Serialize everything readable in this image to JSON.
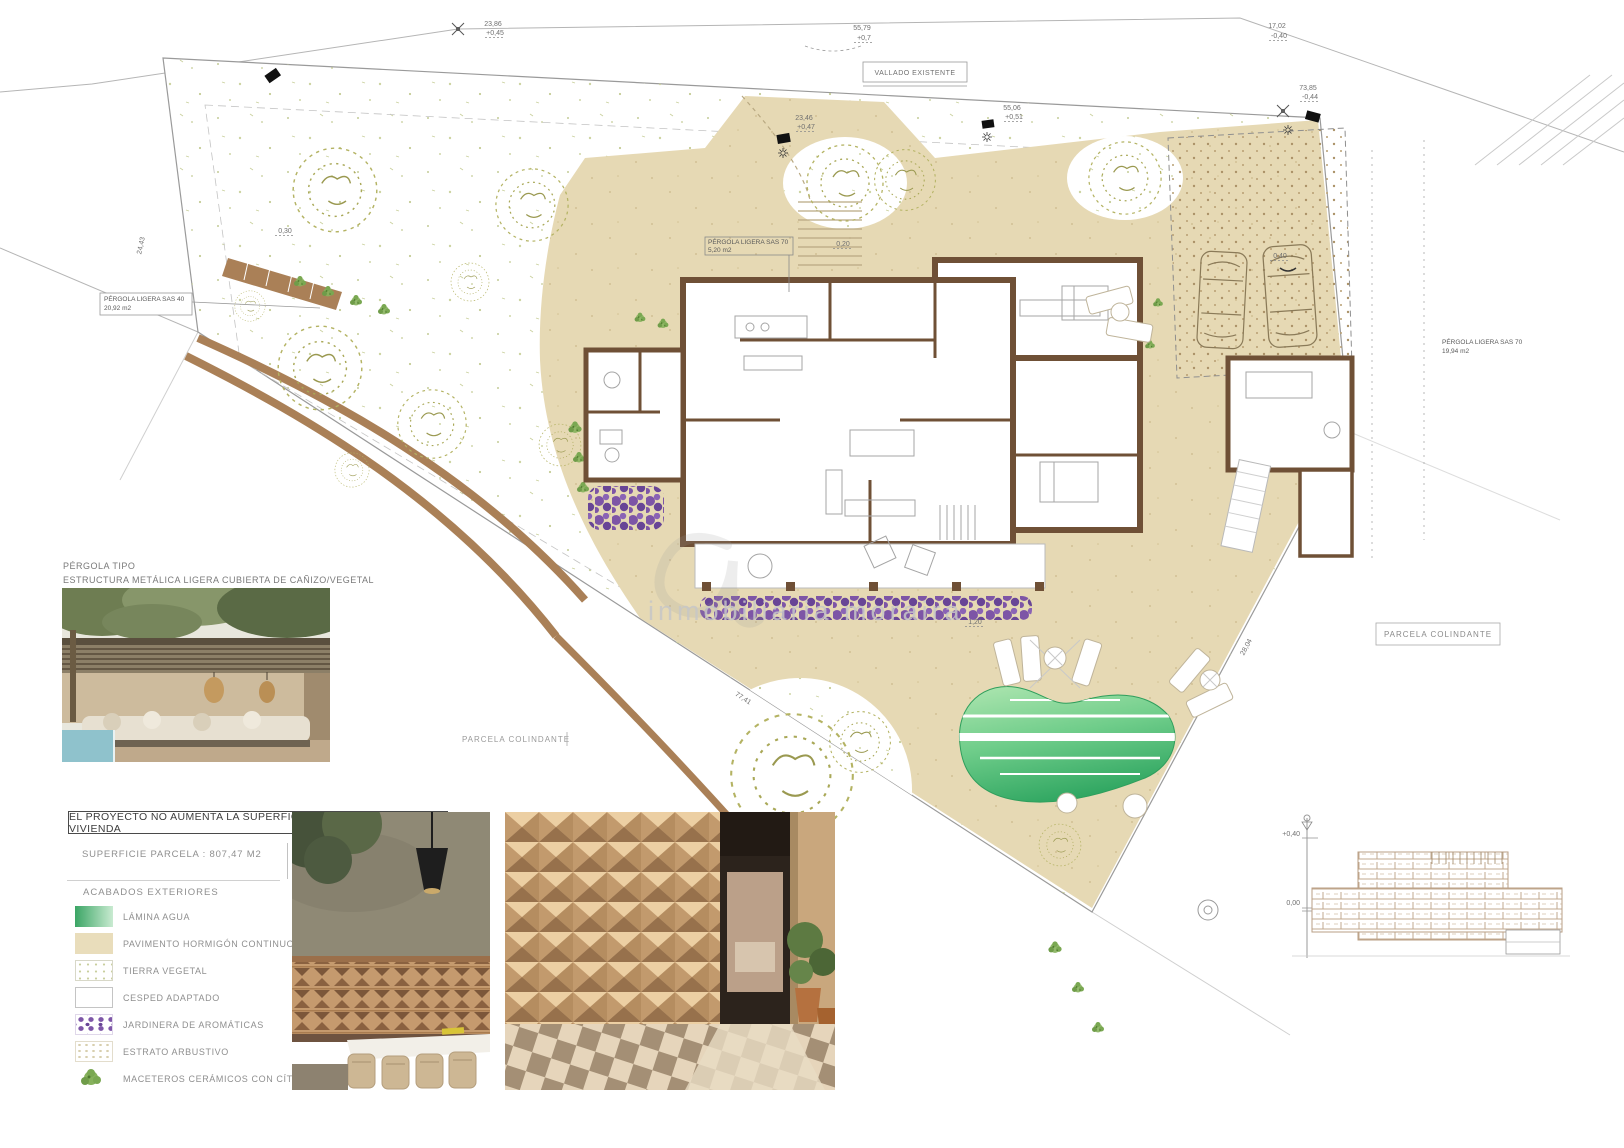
{
  "sheet": {
    "note": "EL PROYECTO NO AUMENTA LA SUPERFICIE CONSTRUIDA DE LA VIVIENDA",
    "superficie": "SUPERFICIE PARCELA : 807,47 M2",
    "acabados_title": "ACABADOS EXTERIORES",
    "pergola_note_line1": "PÉRGOLA TIPO",
    "pergola_note_line2": "ESTRUCTURA METÁLICA LIGERA CUBIERTA DE CAÑIZO/VEGETAL"
  },
  "legend": {
    "items": [
      {
        "label": "LÁMINA AGUA",
        "swatch": "water"
      },
      {
        "label": "PAVIMENTO HORMIGÓN CONTINUO",
        "swatch": "paving"
      },
      {
        "label": "TIERRA VEGETAL",
        "swatch": "terra"
      },
      {
        "label": "CESPED ADAPTADO",
        "swatch": "cesped"
      },
      {
        "label": "JARDINERA DE AROMÁTICAS",
        "swatch": "purple"
      },
      {
        "label": "ESTRATO ARBUSTIVO",
        "swatch": "estrato"
      },
      {
        "label": "MACETEROS CERÁMICOS CON CÍTRICOS",
        "swatch": "plant"
      }
    ]
  },
  "plan": {
    "labels": {
      "vallado": "VALLADO EXISTENTE",
      "parcela_colindante_left": "PARCELA COLINDANTE",
      "parcela_colindante_right": "PARCELA COLINDANTE",
      "pergola40_line1": "PÉRGOLA LIGERA SAS 40",
      "pergola40_line2": "20,92 m2",
      "pergola70_line1": "PÉRGOLA LIGERA SAS 70",
      "pergola70_line2": "5,20 m2",
      "pergola70b_line1": "PÉRGOLA LIGERA SAS 70",
      "pergola70b_line2": "19,94 m2"
    },
    "watermark": "inmobiliaria moraira",
    "annotations": [
      {
        "text": "23,86",
        "x": 493,
        "y": 26
      },
      {
        "text": "+0,45",
        "x": 495,
        "y": 35,
        "ul": true
      },
      {
        "text": "55,79",
        "x": 862,
        "y": 30
      },
      {
        "text": "+0,7",
        "x": 864,
        "y": 40,
        "ul": true
      },
      {
        "text": "17,02",
        "x": 1277,
        "y": 28
      },
      {
        "text": "-0,40",
        "x": 1279,
        "y": 38,
        "ul": true
      },
      {
        "text": "23,46",
        "x": 804,
        "y": 120
      },
      {
        "text": "+0,47",
        "x": 806,
        "y": 129,
        "ul": true
      },
      {
        "text": "55,06",
        "x": 1012,
        "y": 110
      },
      {
        "text": "+0,51",
        "x": 1014,
        "y": 119,
        "ul": true
      },
      {
        "text": "73,85",
        "x": 1308,
        "y": 90
      },
      {
        "text": "-0,44",
        "x": 1310,
        "y": 99,
        "ul": true
      },
      {
        "text": "24,43",
        "x": 143,
        "y": 246,
        "rot": -78
      },
      {
        "text": "77,41",
        "x": 742,
        "y": 700,
        "rot": 33
      },
      {
        "text": "28,04",
        "x": 1248,
        "y": 648,
        "rot": -62
      },
      {
        "text": "0,30",
        "x": 285,
        "y": 233,
        "ul": true
      },
      {
        "text": "0,20",
        "x": 843,
        "y": 246,
        "ul": true
      },
      {
        "text": "1,20",
        "x": 975,
        "y": 624,
        "ul": true
      },
      {
        "text": "0,40",
        "x": 1280,
        "y": 258,
        "ul": true
      },
      {
        "text": "+0,40",
        "x": 1300,
        "y": 836,
        "anchor": "end"
      },
      {
        "text": "0,00",
        "x": 1300,
        "y": 905,
        "anchor": "end"
      }
    ]
  },
  "colors": {
    "paving": "#e6d9b4",
    "wall_brown": "#6f5036",
    "path_brown": "#aa8057",
    "pool_dark": "#2ca45f",
    "pool_light": "#a7e3ac",
    "aromatics_purple": "#7d55a6",
    "tree_olive": "#b4b363"
  }
}
